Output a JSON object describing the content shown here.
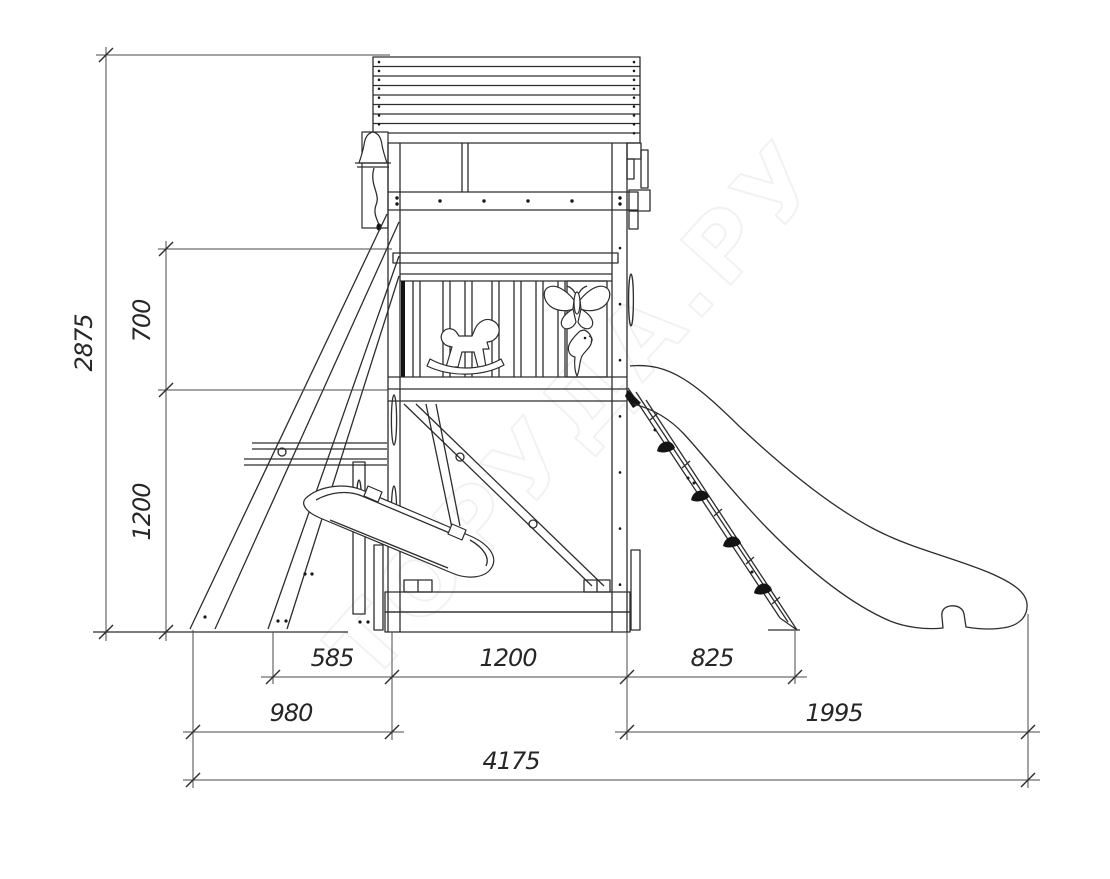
{
  "drawing": {
    "background": "#ffffff",
    "line_color": "#2d2d2d",
    "watermark_text": "ТОРУДА.РУ",
    "watermark_color": "rgba(0,0,0,0.055)"
  },
  "dims": {
    "total_height": "2875",
    "upper_section": "700",
    "lower_section": "1200",
    "span_left": "585",
    "span_tower": "1200",
    "span_ramp": "825",
    "footprint_left": "980",
    "footprint_right": "1995",
    "total_length": "4175"
  }
}
